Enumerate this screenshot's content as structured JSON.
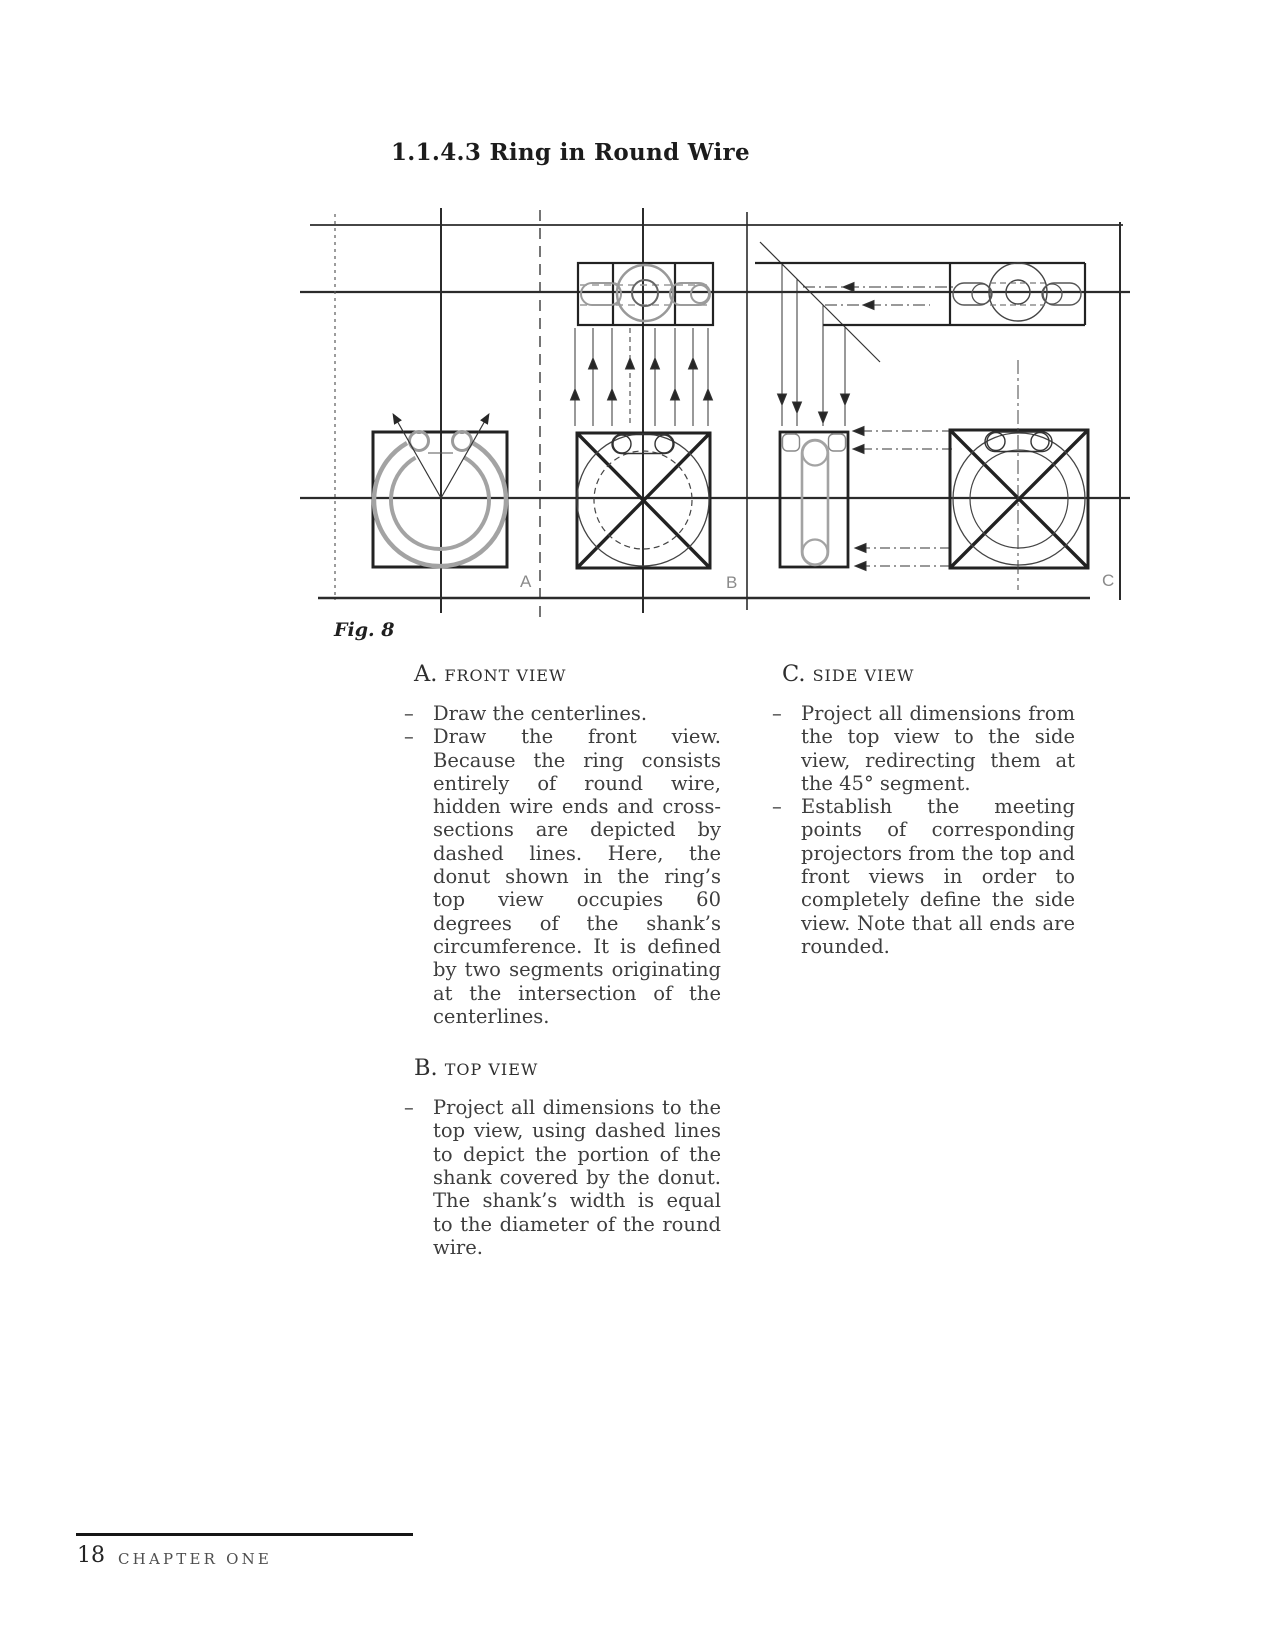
{
  "page": {
    "title": "1.1.4.3 Ring in Round Wire",
    "figure": {
      "caption": "Fig. 8",
      "labels": {
        "a": "A",
        "b": "B",
        "c": "C"
      }
    },
    "bullet_marker": "–",
    "sections": [
      {
        "letter": "A.",
        "name": "FRONT VIEW",
        "bullets": [
          "Draw the centerlines.",
          "Draw the front view. Because the ring consists entirely of round wire, hidden wire ends and cross-sections are depicted by dashed lines. Here, the donut shown in the ring’s top view occupies 60 degrees of the shank’s circumference. It is defined by two segments originating at the intersection of the centerlines."
        ]
      },
      {
        "letter": "B.",
        "name": "TOP VIEW",
        "bullets": [
          "Project all dimensions to the top view, using dashed lines to depict the portion of the shank covered by the donut. The shank’s width is equal to the diameter of the round wire."
        ]
      },
      {
        "letter": "C.",
        "name": "SIDE VIEW",
        "bullets": [
          "Project all dimensions from the top view to the side view, redirecting them at the 45° segment.",
          "Establish the meeting points of corresponding projectors from the top and front views in order to completely define the side view. Note that all ends are rounded."
        ]
      }
    ],
    "footer": {
      "page_number": "18",
      "chapter": "CHAPTER ONE"
    }
  }
}
